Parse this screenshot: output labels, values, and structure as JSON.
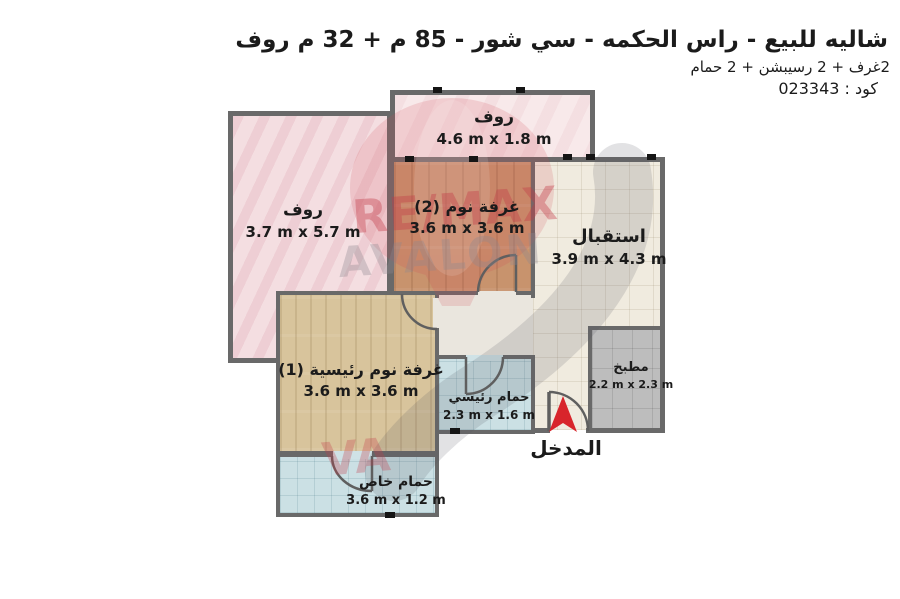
{
  "header": {
    "title": "شاليه للبيع - راس الحكمه - سي شور - 85 م + 32 م روف",
    "subtitle": "2غرف + 2 رسيبشن + 2 حمام",
    "code": "كود : 023343"
  },
  "rooms": {
    "roof_top": {
      "name": "روف",
      "dims": "4.6 m x 1.8 m"
    },
    "roof_left": {
      "name": "روف",
      "dims": "3.7 m x 5.7 m"
    },
    "bedroom_2": {
      "name": "غرفة نوم (2)",
      "dims": "3.6 m x 3.6 m"
    },
    "reception": {
      "name": "استقبال",
      "dims": "3.9 m x 4.3 m"
    },
    "master_bedroom": {
      "name": "غرفة نوم رئيسية (1)",
      "dims": "3.6 m x 3.6 m"
    },
    "main_bathroom": {
      "name": "حمام رئيسي",
      "dims": "2.3 m x 1.6 m"
    },
    "kitchen": {
      "name": "مطبخ",
      "dims": "2.2 m x 2.3 m"
    },
    "private_bathroom": {
      "name": "حمام خاص",
      "dims": "3.6 m x 1.2 m"
    }
  },
  "entrance": {
    "label": "المدخل"
  },
  "watermark": {
    "line1": "RE/MAX",
    "line2": "AVALON",
    "fragment": "VA"
  },
  "colors": {
    "wall": "#696969",
    "entrance_arrow": "#d8252b",
    "roof_fill": "#f4dee1",
    "wood_dark_fill": "#c8936d",
    "wood_light_fill": "#d8c49c",
    "reception_fill": "#f0ebdf",
    "bathroom_fill": "#cbe0e4",
    "kitchen_fill": "#bdbdbd"
  }
}
